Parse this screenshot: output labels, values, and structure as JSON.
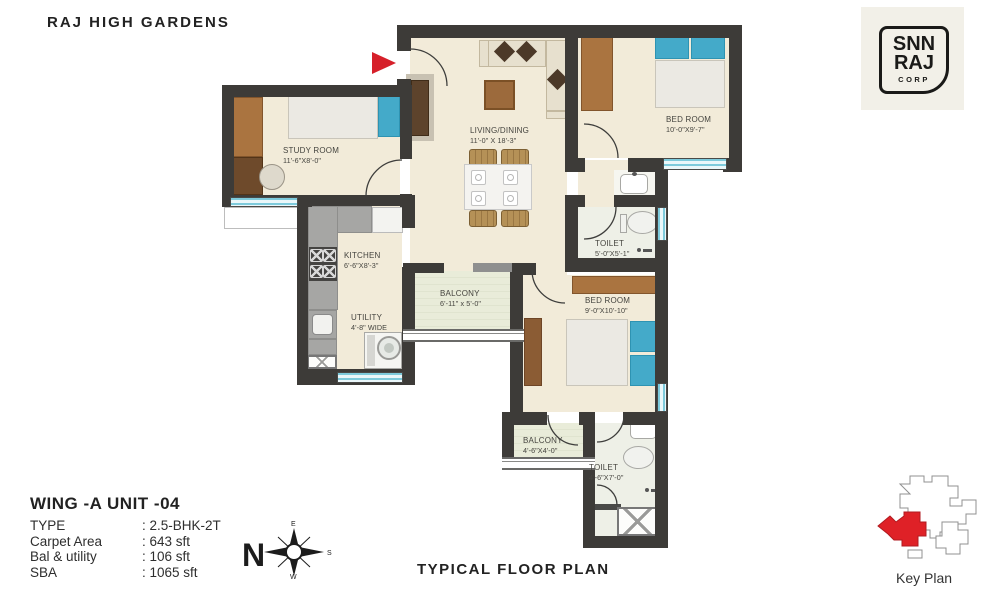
{
  "title": "RAJ HIGH GARDENS",
  "logo": {
    "top": "SNN",
    "mid": "RAJ",
    "bottom": "CORP"
  },
  "rooms": {
    "study": {
      "name": "STUDY ROOM",
      "dims": "11'-6\"X8'-0\""
    },
    "living": {
      "name": "LIVING/DINING",
      "dims": "11'-0\" X 18'-3\""
    },
    "bedroom1": {
      "name": "BED ROOM",
      "dims": "10'-0\"X9'-7\""
    },
    "toilet1": {
      "name": "TOILET",
      "dims": "5'-0\"X5'-1\""
    },
    "kitchen": {
      "name": "KITCHEN",
      "dims": "6'-6\"X8'-3\""
    },
    "utility": {
      "name": "UTILITY",
      "dims": "4'-8\" WIDE"
    },
    "balcony1": {
      "name": "BALCONY",
      "dims": "6'-11\" x 5'-0\""
    },
    "bedroom2": {
      "name": "BED ROOM",
      "dims": "9'-0\"X10'-10\""
    },
    "balcony2": {
      "name": "BALCONY",
      "dims": "4'-6\"X4'-0\""
    },
    "toilet2": {
      "name": "TOILET",
      "dims": "4'-6\"X7'-0\""
    }
  },
  "unit_info": {
    "title": "WING -A  UNIT -04",
    "rows": [
      {
        "label": "TYPE",
        "value": ": 2.5-BHK-2T"
      },
      {
        "label": "Carpet Area",
        "value": ": 643 sft"
      },
      {
        "label": "Bal & utility",
        "value": ": 106 sft"
      },
      {
        "label": "SBA",
        "value": ": 1065 sft"
      }
    ]
  },
  "captions": {
    "plan": "TYPICAL FLOOR PLAN",
    "key_plan": "Key Plan"
  },
  "compass": {
    "n": "N",
    "e": "E",
    "s": "S",
    "w": "W"
  },
  "icons": {
    "entrance": "red-entrance-arrow",
    "compass": "compass-rose",
    "shower": "shower-head-icon"
  },
  "colors": {
    "wall": "#3d3b38",
    "accent_red": "#d6202a",
    "floor": "#f2ebd9",
    "balcony_floor": "#e9ecd9",
    "window": "#7ecbdc",
    "wood": "#aa7440",
    "bed_blue": "#44aac9"
  }
}
